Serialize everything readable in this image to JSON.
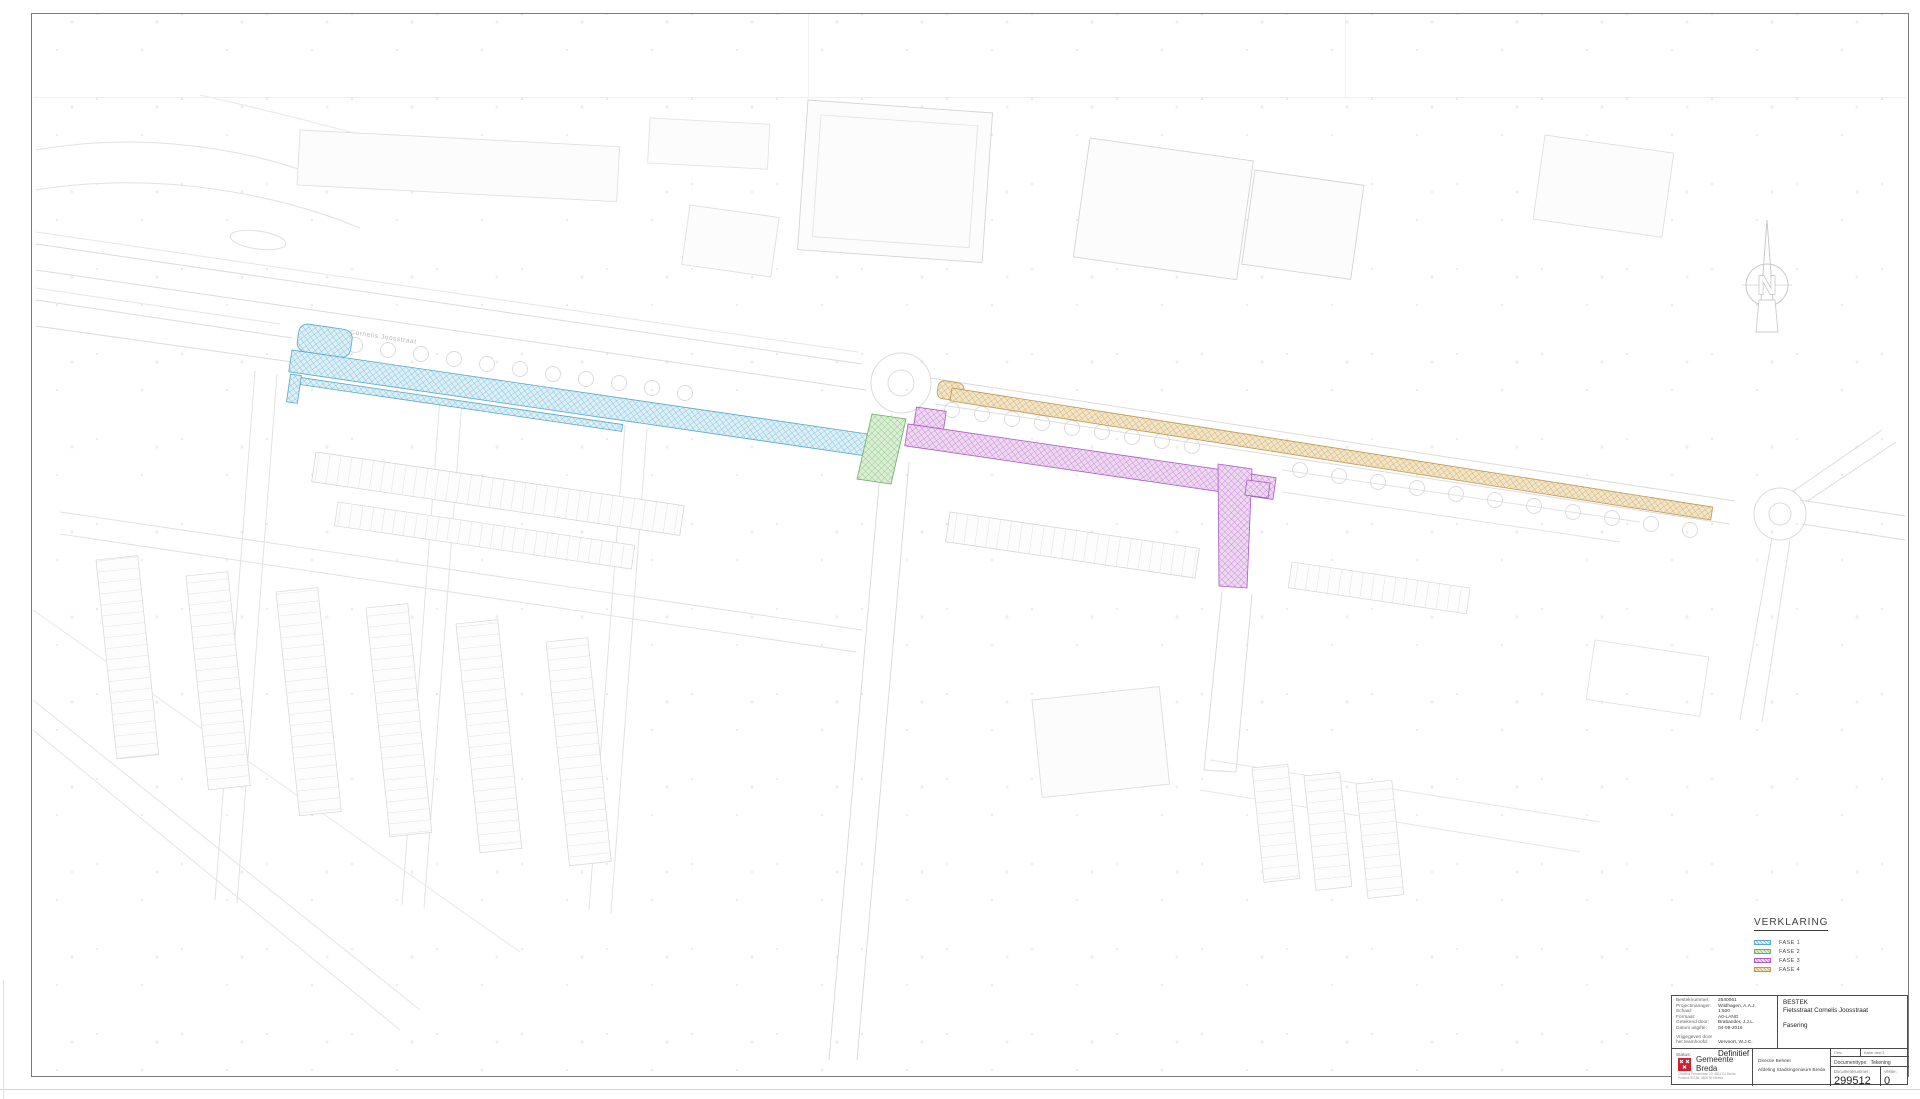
{
  "map": {
    "street_label": "Cornelis Joosstraat",
    "north_arrow_letter": "N",
    "phase_colors": {
      "fase1": "#74b9d6",
      "fase2": "#82c17a",
      "fase3": "#c478ce",
      "fase4": "#c8a260"
    }
  },
  "legend": {
    "title": "VERKLARING",
    "items": [
      {
        "label": "FASE 1",
        "color": "#74b9d6"
      },
      {
        "label": "FASE 2",
        "color": "#82c17a"
      },
      {
        "label": "FASE 3",
        "color": "#c478ce"
      },
      {
        "label": "FASE 4",
        "color": "#c8a260"
      }
    ]
  },
  "title_block": {
    "info_rows": [
      {
        "label": "Besteknummer:",
        "value": "2540061"
      },
      {
        "label": "Projectmanager:",
        "value": "Wildhagen, A.A.J."
      },
      {
        "label": "Schaal:",
        "value": "1:500"
      },
      {
        "label": "Formaat:",
        "value": "A0-LANG"
      },
      {
        "label": "Getekend door:",
        "value": "Brabander, J.J.L."
      },
      {
        "label": "Datum uitgifte:",
        "value": "04-08-2016"
      },
      {
        "label": "Vrijgegeven door het teamhoofd:",
        "value": "Vervoort, W.J.C."
      }
    ],
    "status_label": "Status:",
    "status_value": "Definitief",
    "project": {
      "line1": "BESTEK",
      "line2": "Fietsstraat Cornelis Joosstraat",
      "line3": "Fasering"
    },
    "organization": {
      "name": "Gemeente Breda",
      "brand_color": "#cf2030",
      "address_line1": "Claudius Prinsenlaan 10, 4811 DJ Breda",
      "address_line2": "Postbus 90156, 4800 RH Breda"
    },
    "department": {
      "line1": "Directie Beheer",
      "line2": "Afdeling Stadsingenieurs Breda"
    },
    "document": {
      "meta_left": "Omv.",
      "meta_right": "Kader deel 2",
      "type_label": "Documenttype:",
      "type_value": "Tekening",
      "number_label": "Documentnummer:",
      "number_value": "299512",
      "version_label": "Versie:",
      "version_value": "0"
    }
  }
}
